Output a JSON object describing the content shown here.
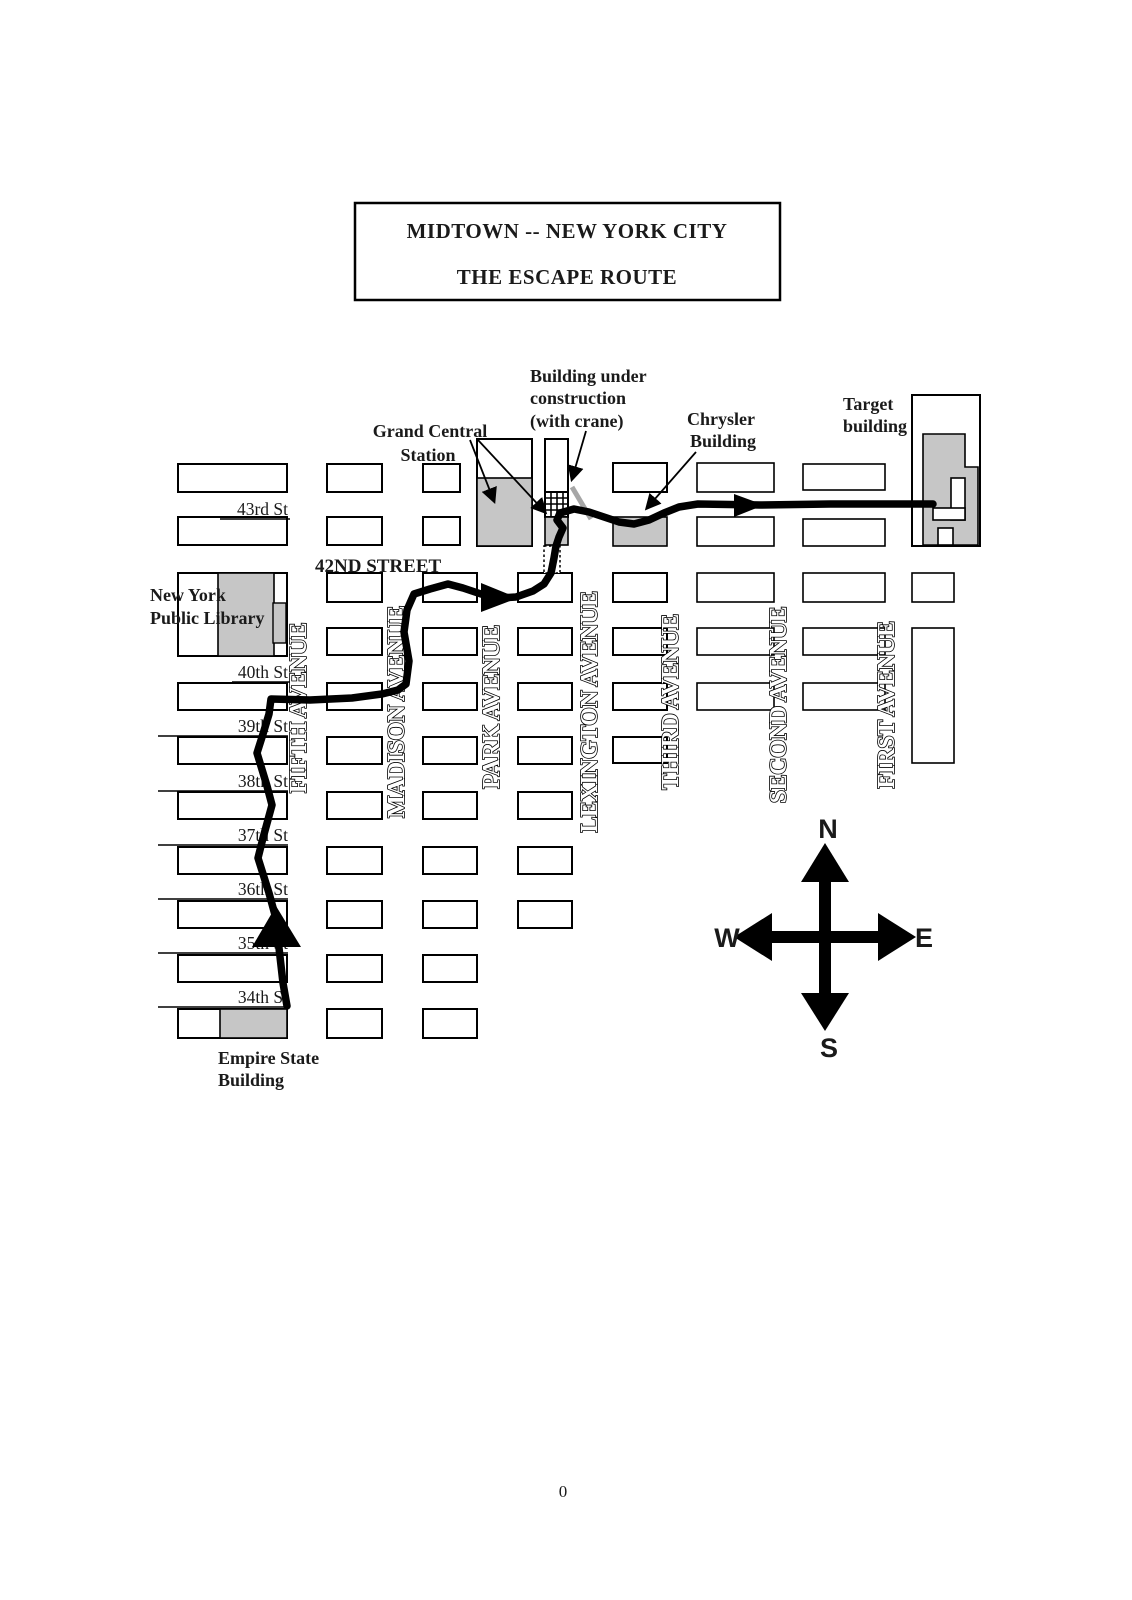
{
  "title": {
    "line1": "MIDTOWN -- NEW YORK CITY",
    "line2": "THE ESCAPE ROUTE"
  },
  "streets": {
    "s43": "43rd St",
    "s42": "42ND STREET",
    "s40": "40th St",
    "s39": "39th St",
    "s38": "38th St",
    "s37": "37th St",
    "s36": "36th St",
    "s35": "35th St",
    "s34": "34th St"
  },
  "avenues": {
    "fifth": "FIFTH AVENUE",
    "madison": "MADISON AVENUE",
    "park": "PARK AVENUE",
    "lexington": "LEXINGTON AVENUE",
    "third": "THIRD AVENUE",
    "second": "SECOND AVENUE",
    "first": "FIRST AVENUE"
  },
  "buildings": {
    "grand_central_1": "Grand Central",
    "grand_central_2": "Station",
    "construction_1": "Building under",
    "construction_2": "construction",
    "construction_3": "(with crane)",
    "chrysler_1": "Chrysler",
    "chrysler_2": "Building",
    "target_1": "Target",
    "target_2": "building",
    "library_1": "New York",
    "library_2": "Public Library",
    "empire_1": "Empire State",
    "empire_2": "Building"
  },
  "compass": {
    "north": "N",
    "south": "S",
    "east": "E",
    "west": "W"
  },
  "page_number": "0",
  "colors": {
    "block_fill": "#ffffff",
    "building_highlight": "#c6c6c6",
    "route": "#000000",
    "crane": "#a6a6a6"
  }
}
